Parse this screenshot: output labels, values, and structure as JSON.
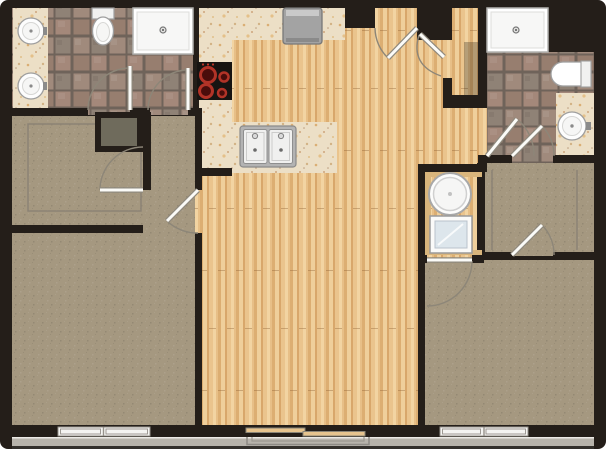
{
  "title": "Two-bedroom two-bathroom apartment floor plan with open kitchen, living area and balcony",
  "colors": {
    "wall": "#241e19",
    "wood": "#e7bf87",
    "carpet": "#a59880",
    "grout": "#6f635a",
    "granite": "#ecdfc6",
    "arc": "#8d8678",
    "closetline": "#8b8274",
    "band": "#b7b3ab",
    "burner": "#b23327",
    "cabinet": "#d9b57c",
    "dryerdrum": "#dde6ec",
    "niche": "#6f6b5c"
  },
  "rooms": [
    {
      "name": "bathroom-1",
      "floor": "tile",
      "fixtures": [
        "double-sink-vanity",
        "toilet",
        "shower"
      ]
    },
    {
      "name": "walk-in-closet-1",
      "floor": "carpet",
      "features": [
        "closet-outline",
        "linen-niche"
      ]
    },
    {
      "name": "hallway-1",
      "floor": "carpet"
    },
    {
      "name": "bedroom-1",
      "floor": "carpet",
      "features": [
        "window"
      ]
    },
    {
      "name": "kitchen",
      "floor": "wood",
      "fixtures": [
        "refrigerator",
        "range-cooktop",
        "counter-run",
        "island-double-sink"
      ]
    },
    {
      "name": "living-dining",
      "floor": "wood",
      "features": [
        "sliding-glass-door",
        "balcony-outline"
      ]
    },
    {
      "name": "entry",
      "floor": "wood",
      "features": [
        "entry-door",
        "coat-closet"
      ]
    },
    {
      "name": "laundry-closet",
      "floor": "wood",
      "fixtures": [
        "washer",
        "dryer"
      ]
    },
    {
      "name": "bathroom-2",
      "floor": "tile",
      "fixtures": [
        "shower",
        "toilet",
        "single-sink-vanity"
      ]
    },
    {
      "name": "walk-through-closet-2",
      "floor": "carpet",
      "features": [
        "closet-outline"
      ]
    },
    {
      "name": "bedroom-2",
      "floor": "carpet",
      "features": [
        "window"
      ]
    }
  ],
  "door_count": 10,
  "window_count": 2,
  "sliding_door_count": 1
}
